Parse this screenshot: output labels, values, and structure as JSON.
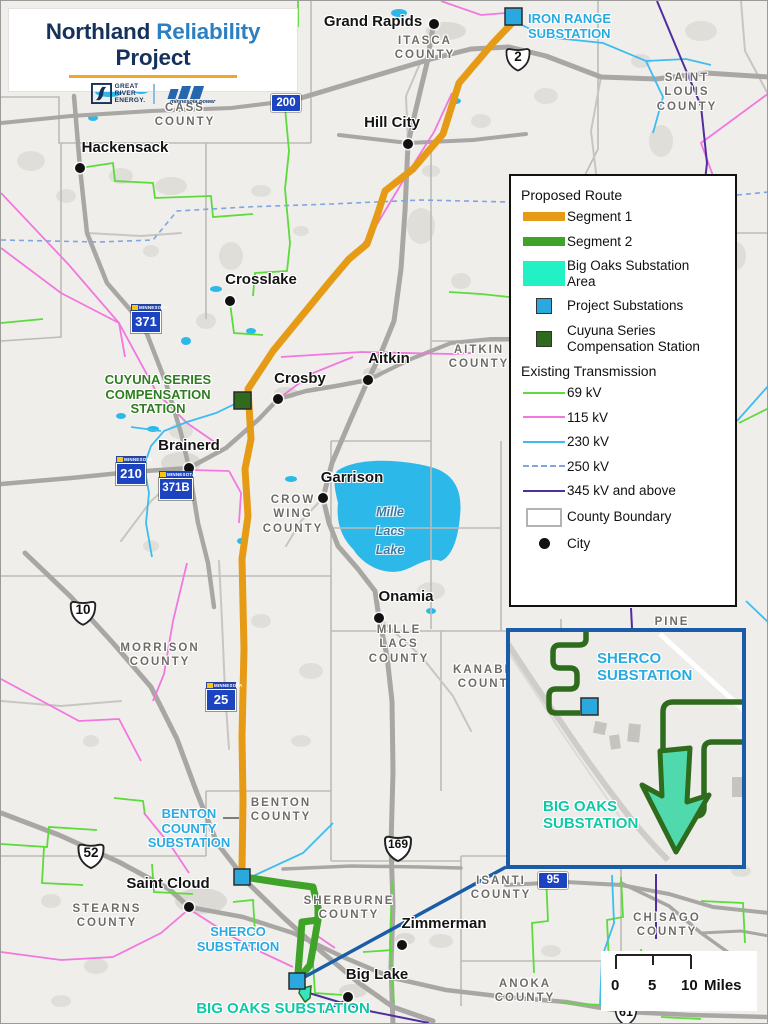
{
  "title_card": {
    "title": [
      {
        "text": "Northland"
      },
      {
        "text": "Reliability"
      },
      {
        "text": "Project"
      }
    ],
    "gre_logo": {
      "line1": "GREAT",
      "line2": "RIVER",
      "line3": "ENERGY."
    },
    "mp_logo": {
      "name": "minnesota power"
    }
  },
  "legend": {
    "section1_header": "Proposed Route",
    "segment1": "Segment 1",
    "segment2": "Segment 2",
    "big_oaks_area": "Big Oaks Substation Area",
    "project_substations": "Project Substations",
    "cuyuna_station": "Cuyuna Series Compensation Station",
    "section2_header": "Existing Transmission",
    "kv69": "69 kV",
    "kv115": "115 kV",
    "kv230": "230 kV",
    "kv250": "250 kV",
    "kv345": "345 kV and above",
    "county_boundary": "County Boundary",
    "city": "City"
  },
  "colors": {
    "segment1": "#E69B16",
    "segment2": "#3FA32A",
    "big_oaks_area": "#21F1C4",
    "project_substation": "#2BA9DE",
    "cuyuna_station": "#2F6B1C",
    "kv69": "#5CDB3A",
    "kv115": "#F277DE",
    "kv230": "#3EBCEF",
    "kv250": "#7FA6E0",
    "kv345": "#4F2E9E",
    "substation_label": "#29ABE2",
    "big_oaks_label": "#0FC9A4",
    "inset_border": "#1A5DA6",
    "lake": "#2CB9EA"
  },
  "map": {
    "counties": [
      {
        "name": "ITASCA COUNTY"
      },
      {
        "name": "SAINT LOUIS COUNTY"
      },
      {
        "name": "CASS COUNTY"
      },
      {
        "name": "AITKIN COUNTY"
      },
      {
        "name": "CROW WING COUNTY"
      },
      {
        "name": "MILLE LACS COUNTY"
      },
      {
        "name": "MORRISON COUNTY"
      },
      {
        "name": "BENTON COUNTY"
      },
      {
        "name": "SHERBURNE COUNTY"
      },
      {
        "name": "STEARNS COUNTY"
      },
      {
        "name": "ISANTI COUNTY"
      },
      {
        "name": "ANOKA COUNTY"
      },
      {
        "name": "CHISAGO COUNTY"
      },
      {
        "name": "KANABEC COUNTY"
      },
      {
        "name": "PINE COUNTY"
      }
    ],
    "cities": [
      {
        "name": "Grand Rapids"
      },
      {
        "name": "Hill City"
      },
      {
        "name": "Hackensack"
      },
      {
        "name": "Crosslake"
      },
      {
        "name": "Aitkin"
      },
      {
        "name": "Crosby"
      },
      {
        "name": "Brainerd"
      },
      {
        "name": "Garrison"
      },
      {
        "name": "Onamia"
      },
      {
        "name": "Saint Cloud"
      },
      {
        "name": "Zimmerman"
      },
      {
        "name": "Big Lake"
      }
    ],
    "substations": {
      "iron_range": "IRON RANGE SUBSTATION",
      "cuyuna": "CUYUNA SERIES COMPENSATION STATION",
      "benton": "BENTON COUNTY SUBSTATION",
      "sherco": "SHERCO SUBSTATION",
      "big_oaks": "BIG OAKS SUBSTATION"
    },
    "inset": {
      "sherco": "SHERCO SUBSTATION",
      "big_oaks": "BIG OAKS SUBSTATION"
    },
    "lake_label": "Mille Lacs Lake",
    "shields": {
      "us": [
        "2",
        "10",
        "52",
        "169",
        "61"
      ],
      "mn": [
        "371",
        "210",
        "371B",
        "25"
      ],
      "mn_plain": [
        "200",
        "95"
      ],
      "banner": "MINNESOTA"
    },
    "scale_bar": {
      "t0": "0",
      "t1": "5",
      "t2": "10",
      "unit": "Miles"
    }
  }
}
